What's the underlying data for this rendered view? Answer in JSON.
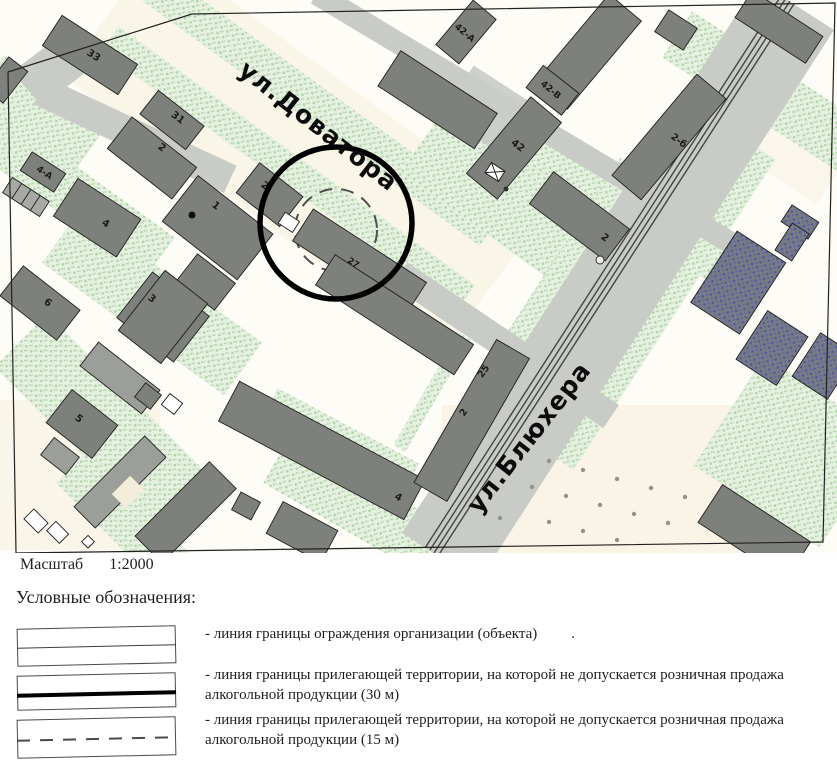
{
  "map": {
    "scale_label": "Масштаб",
    "scale_value": "1:2000",
    "streets": [
      {
        "name": "ул.Доватора"
      },
      {
        "name": "ул.Блюхера"
      }
    ],
    "building_labels": [
      "33",
      "31",
      "2",
      "4-А",
      "4",
      "1",
      "2",
      "27",
      "3",
      "6",
      "5",
      "4",
      "25",
      "2",
      "42-А",
      "42-В",
      "42",
      "2-б",
      "2"
    ],
    "colors": {
      "building": "#7d807b",
      "secondary_building": "#9b9e99",
      "blue_building": "#565ea2",
      "road": "#c9ccc6",
      "vegetation": "#b3d4ab",
      "boundary_circle": "#000000",
      "background": "#fdfcf6"
    }
  },
  "legend": {
    "title": "Условные обозначения:",
    "items": [
      {
        "text": "- линия границы ограждения организации (объекта)",
        "suffix": "."
      },
      {
        "text": "- линия границы прилегающей территории, на которой не допускается розничная продажа алкогольной продукции (30 м)",
        "suffix": ""
      },
      {
        "text": "- линия границы прилегающей территории, на которой не допускается розничная продажа алкогольной продукции (15 м)",
        "suffix": ""
      }
    ]
  }
}
